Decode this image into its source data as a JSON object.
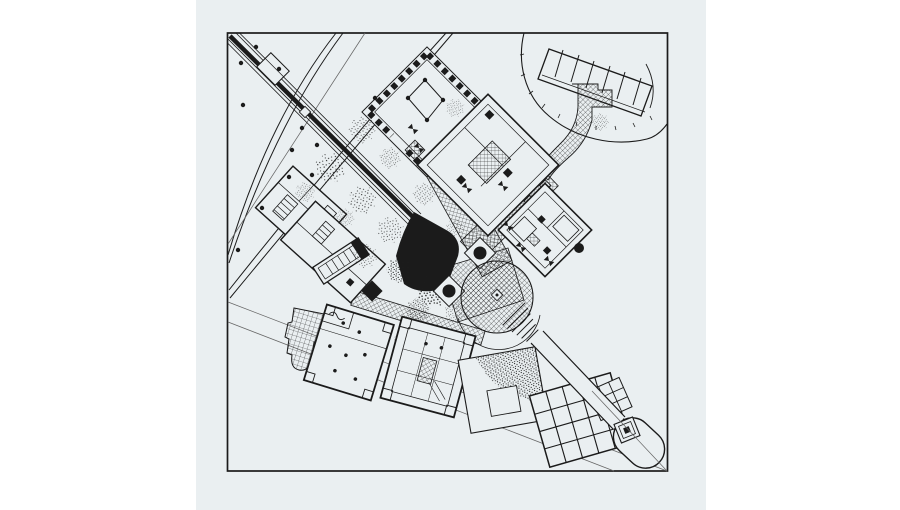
{
  "meta": {
    "domain": "architectural-site-plan",
    "title": "Site plan drawing"
  },
  "theme": {
    "page-bg": "#ffffff",
    "scan-bg": "#eaeff1",
    "ink": "#1b1b1b",
    "faint": "#666666"
  },
  "figure": {
    "aria_label": "Scanned black-and-white architectural site plan: rotated square pavilions linked by crosshatched walkways, a diagonal entry spine from the upper left corner, two ring-road arcs, a scalloped tree canopy with a striped terrace at the upper right, stippled tree masses, a black fan-shaped auditorium, a circular plaza, lawn and grid plazas below, and a long thin walkway running to a rounded belvedere at the lower right.",
    "elements": [
      {
        "name": "plan-frame",
        "kind": "border square"
      },
      {
        "name": "ring-road-inner-arc",
        "kind": "double-line arc"
      },
      {
        "name": "ring-road-outer-arc",
        "kind": "double-line arc"
      },
      {
        "name": "entry-spine",
        "kind": "thick diagonal axis with flanking lines"
      },
      {
        "name": "spine-gate",
        "kind": "small gate structure on spine"
      },
      {
        "name": "tree-canopy",
        "kind": "scalloped circle"
      },
      {
        "name": "striped-terrace",
        "kind": "tilted rectangle with parallel bars"
      },
      {
        "name": "winding-walk",
        "kind": "crosshatched path"
      },
      {
        "name": "mall-walk",
        "kind": "crosshatched pedestrian mall"
      },
      {
        "name": "colonnade-pavilion",
        "kind": "45-degree square with checkered colonnade and inner court"
      },
      {
        "name": "court-pavilion",
        "kind": "45-degree square pavilion with central stair"
      },
      {
        "name": "hall-pavilion",
        "kind": "45-degree square pavilion with rooms"
      },
      {
        "name": "west-wing-complex",
        "kind": "rotated wing with stair rooms"
      },
      {
        "name": "stair-bar-annex",
        "kind": "ladder-like bar"
      },
      {
        "name": "auditorium-fan",
        "kind": "solid black wedge"
      },
      {
        "name": "fountain-basins",
        "kind": "two squares with black discs"
      },
      {
        "name": "rotunda-plaza",
        "kind": "crosshatched circle with funnel steps"
      },
      {
        "name": "southeast-walkway",
        "kind": "thin double-line spine"
      },
      {
        "name": "garden-parcel",
        "kind": "square with stippled grove and court"
      },
      {
        "name": "grid-plaza",
        "kind": "coarse gridded terrace"
      },
      {
        "name": "belvedere-capsule",
        "kind": "round-ended terminus"
      },
      {
        "name": "obelisk-fountain",
        "kind": "concentric squares"
      },
      {
        "name": "southwest-block",
        "kind": "rotated square building"
      },
      {
        "name": "courtyard-block",
        "kind": "rotated square building with inner court"
      },
      {
        "name": "paved-apron",
        "kind": "fine grid stepped plaza"
      },
      {
        "name": "boundary-lines",
        "kind": "faint survey lines"
      },
      {
        "name": "tree-stipples",
        "kind": "stippled tree masses"
      },
      {
        "name": "tree-dots",
        "kind": "single tree dots"
      }
    ]
  }
}
